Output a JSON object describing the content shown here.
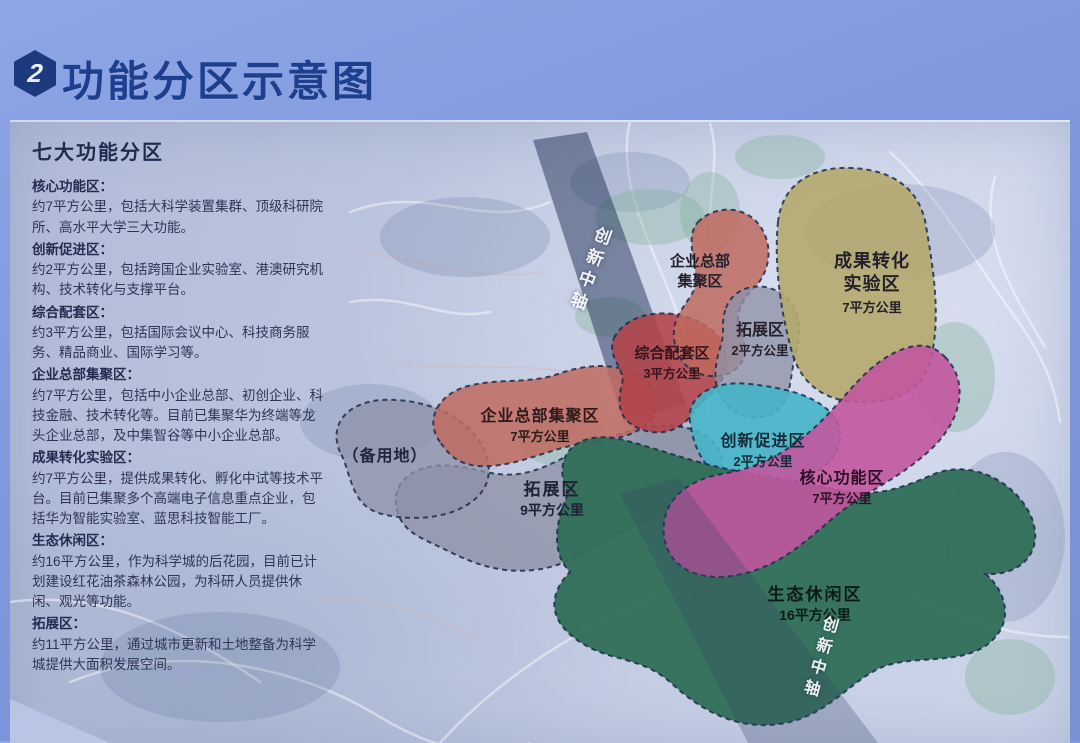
{
  "header": {
    "badge": "2",
    "title": "功能分区示意图"
  },
  "panel": {
    "title": "七大功能分区",
    "legend": [
      {
        "name": "核心功能区：",
        "desc": "约7平方公里，包括大科学装置集群、顶级科研院所、高水平大学三大功能。"
      },
      {
        "name": "创新促进区：",
        "desc": "约2平方公里，包括跨国企业实验室、港澳研究机构、技术转化与支撑平台。"
      },
      {
        "name": "综合配套区：",
        "desc": "约3平方公里，包括国际会议中心、科技商务服务、精品商业、国际学习等。"
      },
      {
        "name": "企业总部集聚区：",
        "desc": "约7平方公里，包括中小企业总部、初创企业、科技金融、技术转化等。目前已集聚华为终端等龙头企业总部，及中集智谷等中小企业总部。"
      },
      {
        "name": "成果转化实验区：",
        "desc": "约7平方公里，提供成果转化、孵化中试等技术平台。目前已集聚多个高端电子信息重点企业，包括华为智能实验室、蓝思科技智能工厂。"
      },
      {
        "name": "生态休闲区：",
        "desc": "约16平方公里，作为科学城的后花园，目前已计划建设红花油茶森林公园，为科研人员提供休闲、观光等功能。"
      },
      {
        "name": "拓展区：",
        "desc": "约11平方公里，通过城市更新和土地整备为科学城提供大面积发展空间。"
      }
    ]
  },
  "map": {
    "axis_label": "创新中轴",
    "reserved_label": "（备用地）",
    "zones": {
      "hq_top": {
        "name": "企业总部",
        "name2": "集聚区"
      },
      "achievement": {
        "name": "成果转化",
        "name2": "实验区",
        "area": "7平方公里"
      },
      "expansion2": {
        "name": "拓展区",
        "area": "2平方公里"
      },
      "composite": {
        "name": "综合配套区",
        "area": "3平方公里"
      },
      "hq_main": {
        "name": "企业总部集聚区",
        "area": "7平方公里"
      },
      "expansion9": {
        "name": "拓展区",
        "area": "9平方公里"
      },
      "innovation": {
        "name": "创新促进区",
        "area": "2平方公里"
      },
      "core": {
        "name": "核心功能区",
        "area": "7平方公里"
      },
      "eco": {
        "name": "生态休闲区",
        "area": "16平方公里"
      }
    },
    "colors": {
      "gray": "#8e92a8",
      "salmon": "#c06a5f",
      "red": "#b2454b",
      "yellow": "#b4a96d",
      "cyan": "#45b4c8",
      "magenta": "#c2579e",
      "green": "#2f6e57",
      "title_blue": "#1d3f8e"
    }
  }
}
